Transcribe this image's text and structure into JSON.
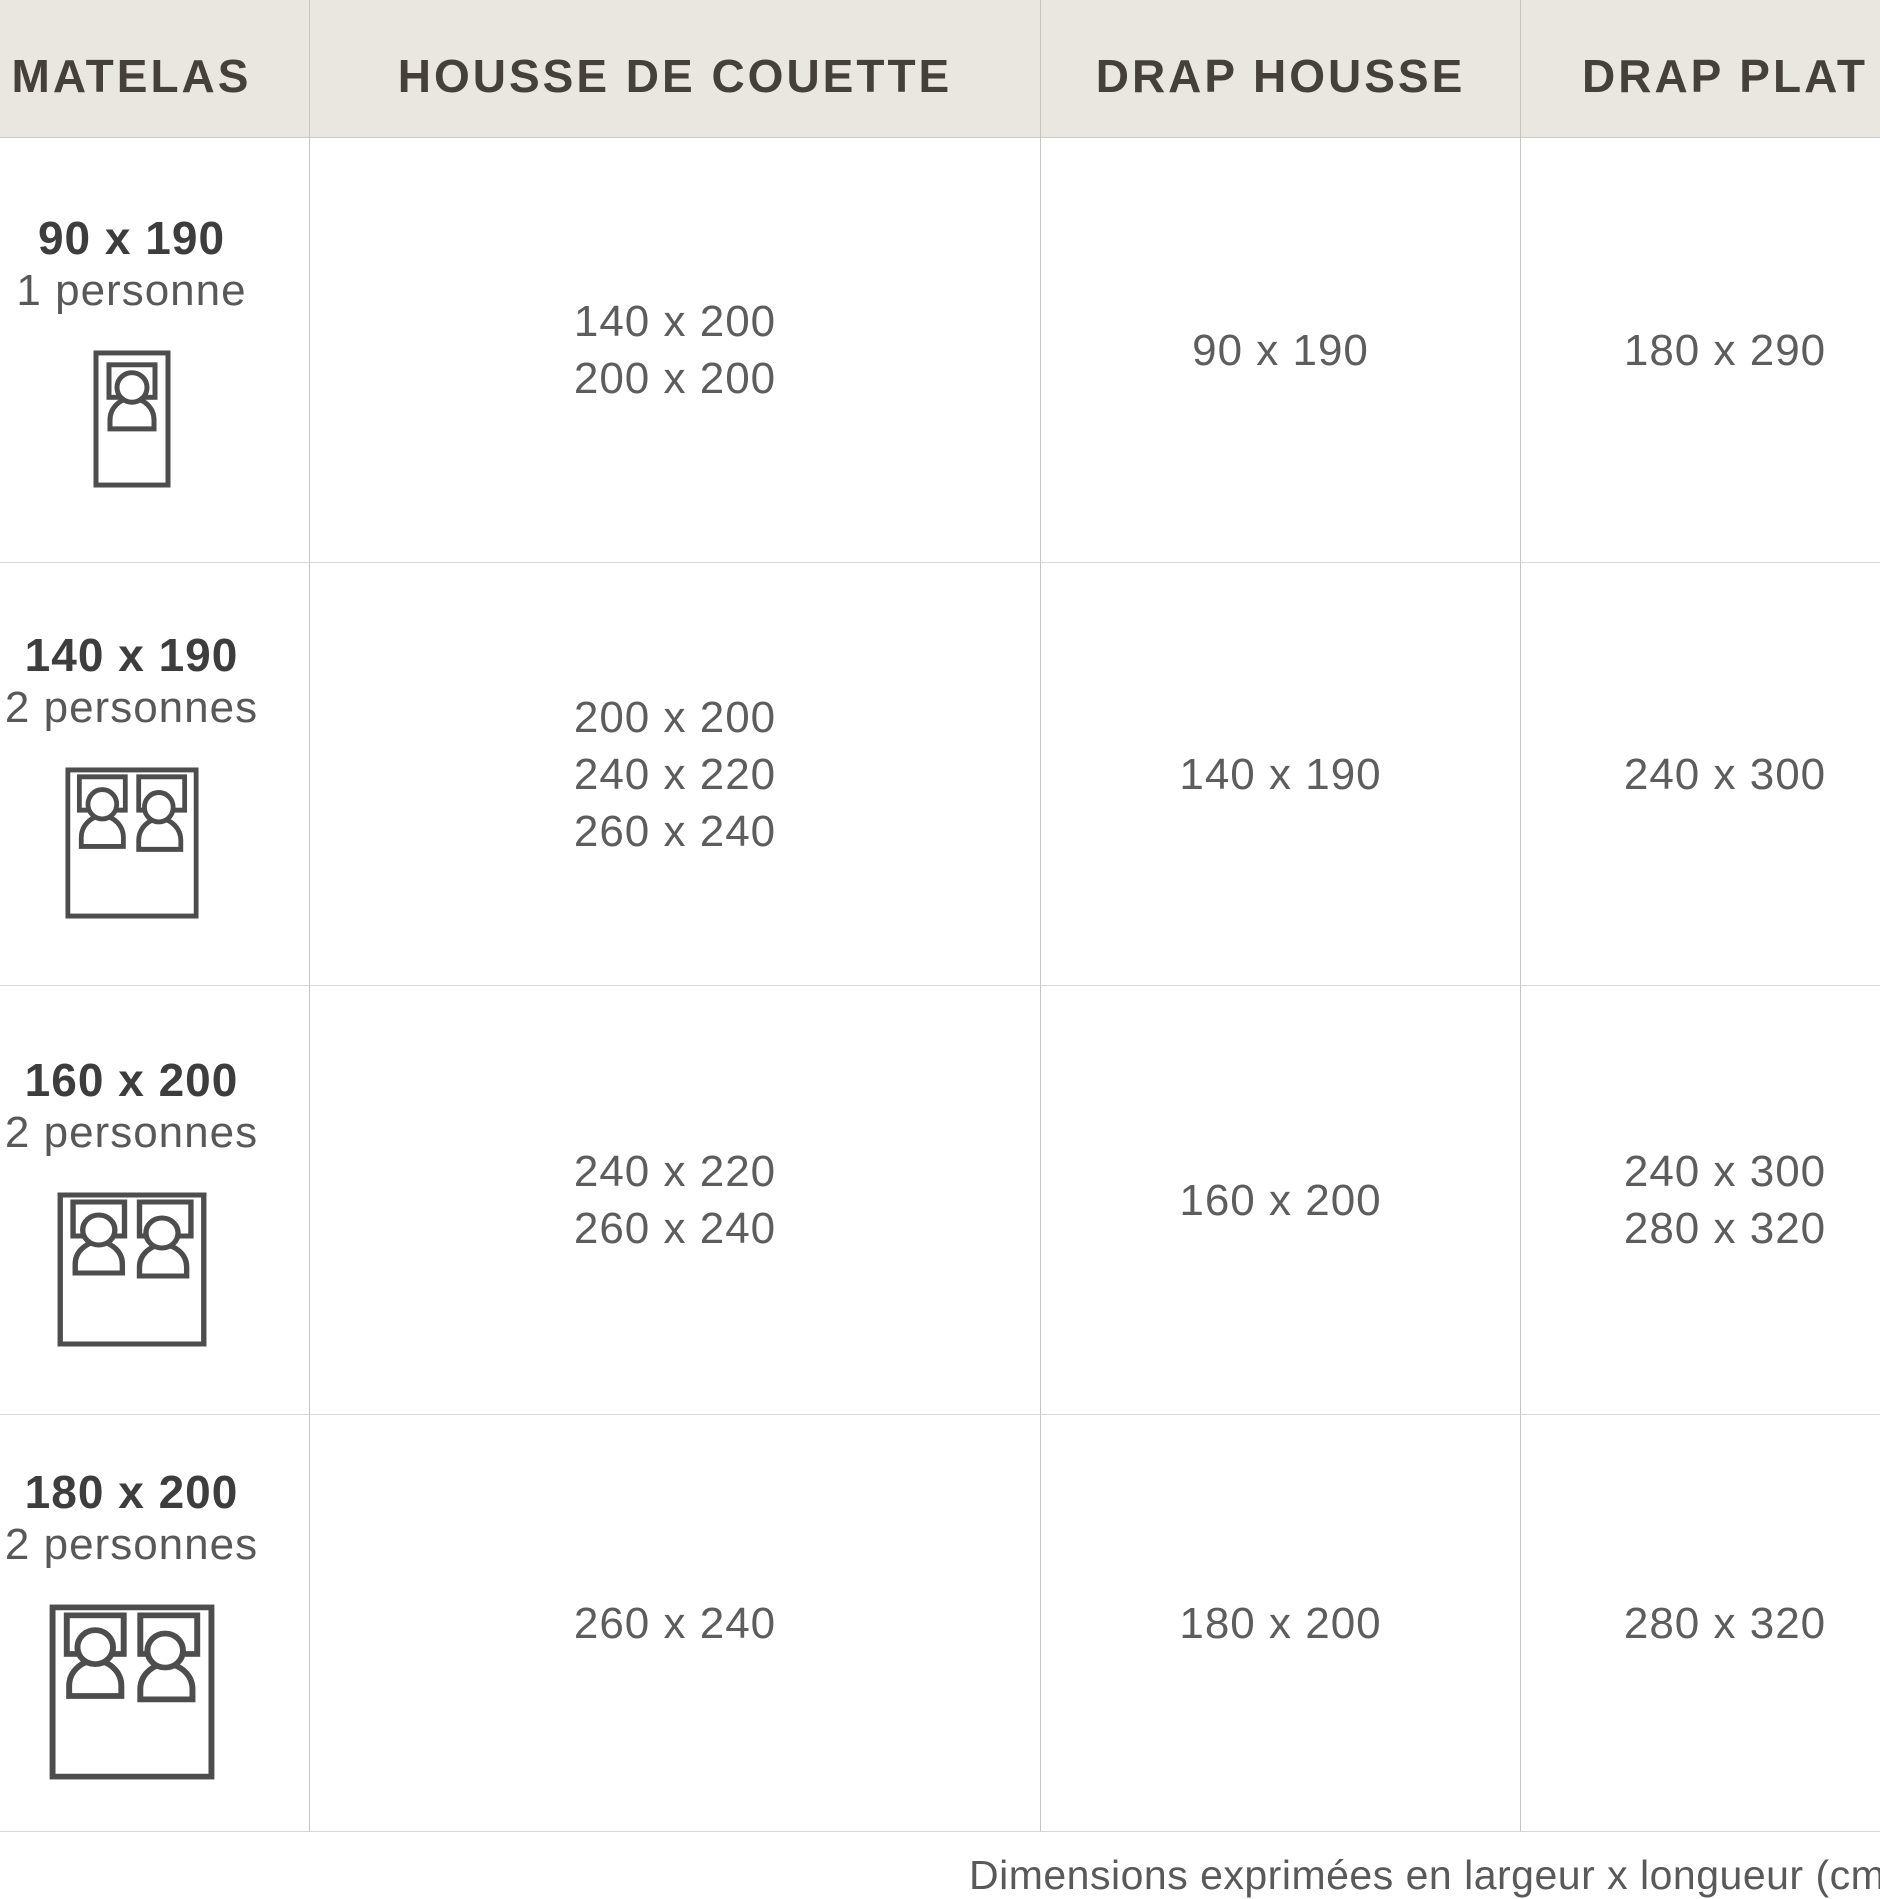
{
  "table": {
    "headers": {
      "matelas": "MATELAS",
      "housse_de_couette": "HOUSSE DE COUETTE",
      "drap_housse": "DRAP HOUSSE",
      "drap_plat": "DRAP PLAT"
    },
    "rows": [
      {
        "matelas": {
          "size": "90 x 190",
          "persons": "1 personne",
          "icon": "single-bed-icon"
        },
        "housse_de_couette": [
          "140 x 200",
          "200 x 200"
        ],
        "drap_housse": [
          "90 x 190"
        ],
        "drap_plat": [
          "180 x 290"
        ]
      },
      {
        "matelas": {
          "size": "140 x 190",
          "persons": "2 personnes",
          "icon": "double-bed-icon"
        },
        "housse_de_couette": [
          "200 x 200",
          "240 x 220",
          "260 x 240"
        ],
        "drap_housse": [
          "140 x 190"
        ],
        "drap_plat": [
          "240 x 300"
        ]
      },
      {
        "matelas": {
          "size": "160 x 200",
          "persons": "2 personnes",
          "icon": "double-bed-icon"
        },
        "housse_de_couette": [
          "240 x 220",
          "260 x 240"
        ],
        "drap_housse": [
          "160 x 200"
        ],
        "drap_plat": [
          "240 x 300",
          "280 x 320"
        ]
      },
      {
        "matelas": {
          "size": "180 x 200",
          "persons": "2 personnes",
          "icon": "double-bed-icon"
        },
        "housse_de_couette": [
          "260 x 240"
        ],
        "drap_housse": [
          "180 x 200"
        ],
        "drap_plat": [
          "280 x 320"
        ]
      }
    ],
    "footnote": "Dimensions exprimées en largeur x longueur (cm)"
  },
  "colors": {
    "header_bg": "#eae7e0",
    "header_text": "#454039",
    "cell_bg": "#ffffff",
    "value_text": "#5d5d5d",
    "size_text": "#3d3d3d",
    "border": "#d9d8d6",
    "column_divider": "#c7c6c3",
    "icon_stroke": "#4d4d4d"
  }
}
